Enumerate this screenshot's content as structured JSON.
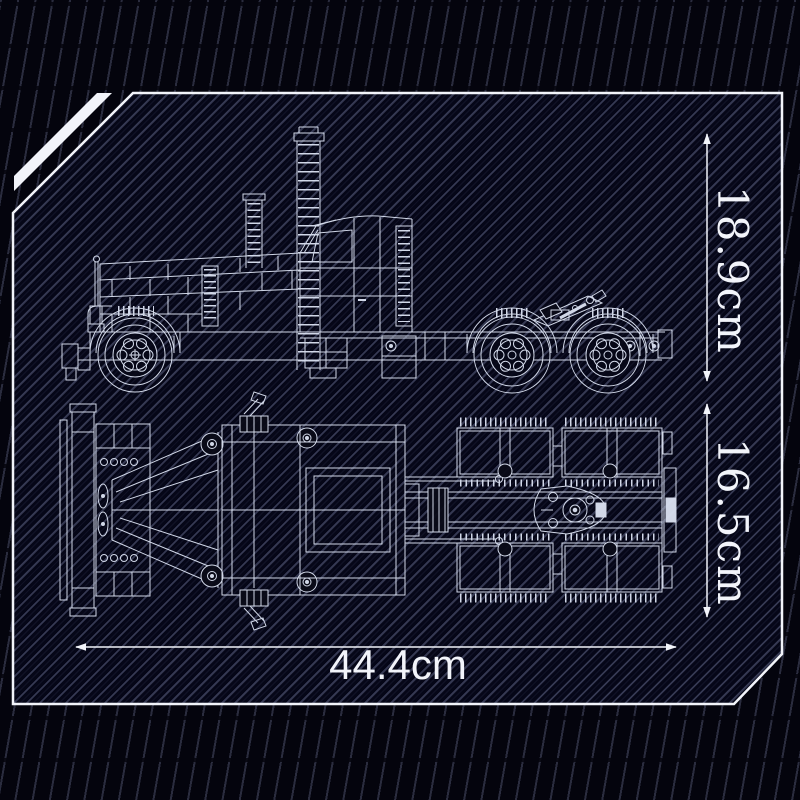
{
  "frame": {
    "stroke_color": "#f2f4fa"
  },
  "background": {
    "base_color": "#04040d",
    "panel_color": "#050617",
    "stripe_color": "#8a92b3"
  },
  "blueprint": {
    "line_color": "#dce3f3"
  },
  "dimensions": {
    "height": {
      "label": "18.9cm"
    },
    "width": {
      "label": "16.5cm"
    },
    "length": {
      "label": "44.4cm"
    }
  }
}
